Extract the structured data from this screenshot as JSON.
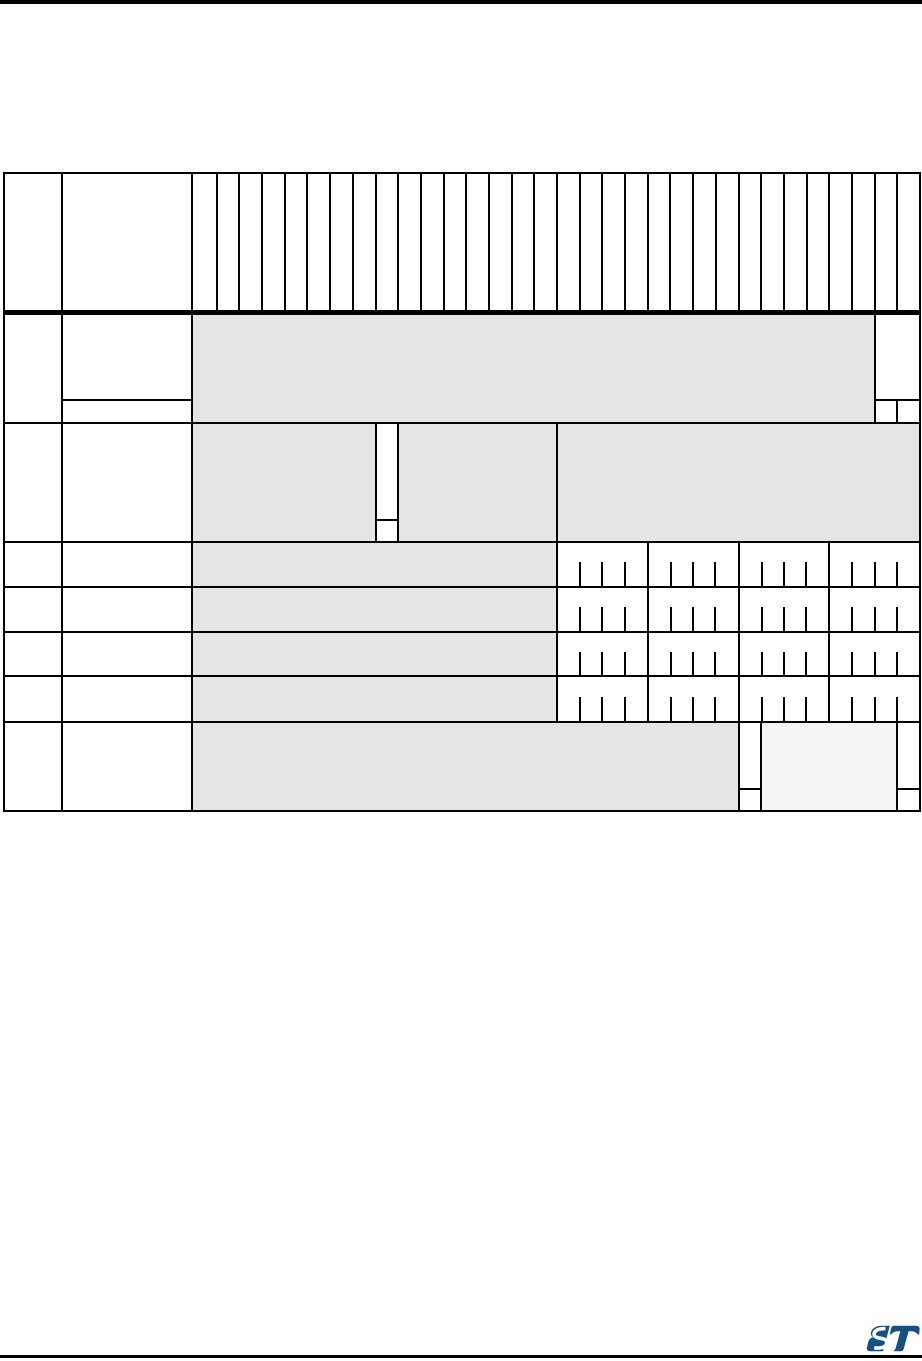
{
  "page": {
    "background": "#ffffff",
    "top_rule_color": "#000000",
    "bottom_rule_color": "#000000"
  },
  "colors": {
    "table_border": "#000000",
    "reserved_cell_fill": "#e4e5e4",
    "light_reserved_cell_fill": "#f5f5f6",
    "field_cell_fill": "#ffffff",
    "logo_blue": "#17507f"
  },
  "register_table": {
    "bit_column_count": 32,
    "header": {
      "offset_col_text": "",
      "register_col_text": "",
      "bit_labels": []
    },
    "rows": [
      {
        "name": "row-1",
        "reserved_bits": "31:2",
        "field_bits": "1:0",
        "has_reset_subrow": true
      },
      {
        "name": "row-2",
        "reserved_bits": "31:24, 22:16, 15:0",
        "field_bits": "23",
        "has_reset_subrow": true
      },
      {
        "name": "row-3",
        "reserved_bits": "31:16",
        "field_bits": "15:0",
        "reset_bit_ticks": true
      },
      {
        "name": "row-4",
        "reserved_bits": "31:16",
        "field_bits": "15:0",
        "reset_bit_ticks": true
      },
      {
        "name": "row-5",
        "reserved_bits": "31:16",
        "field_bits": "15:0",
        "reset_bit_ticks": true
      },
      {
        "name": "row-6",
        "reserved_bits": "31:16",
        "field_bits": "15:0",
        "reset_bit_ticks": true
      },
      {
        "name": "row-7",
        "reserved_bits": "31:8, 6:1",
        "field_bits": "7, 0",
        "has_reset_subrow": true
      }
    ]
  },
  "footer": {
    "logo": "st-microelectronics-logo"
  }
}
